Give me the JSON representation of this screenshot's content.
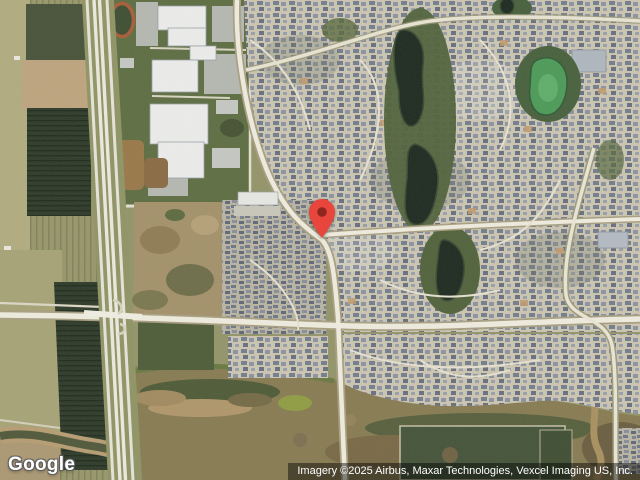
{
  "map": {
    "view": "satellite",
    "watermark": {
      "logo_text": "Google"
    },
    "attribution": {
      "text": "Imagery ©2025 Airbus, Maxar Technologies, Vexcel Imaging US, Inc."
    },
    "marker": {
      "name": "location-pin",
      "x": 322,
      "y": 238,
      "color": "#E8453C",
      "dot_color": "#8E2620"
    },
    "palette": {
      "field_olive": "#9C9C6C",
      "orchard_dark": "#2E3A29",
      "grass_green": "#5D6D41",
      "housing_base": "#CBC5B1",
      "roof_gray_blue": "#747D8C",
      "road_white": "#EFECDF",
      "pond_dark": "#1D2A20",
      "pond_green": "#4C9A58",
      "wetland_brown": "#877B52",
      "attribution_bg": "rgba(0,0,0,0.45)"
    }
  }
}
